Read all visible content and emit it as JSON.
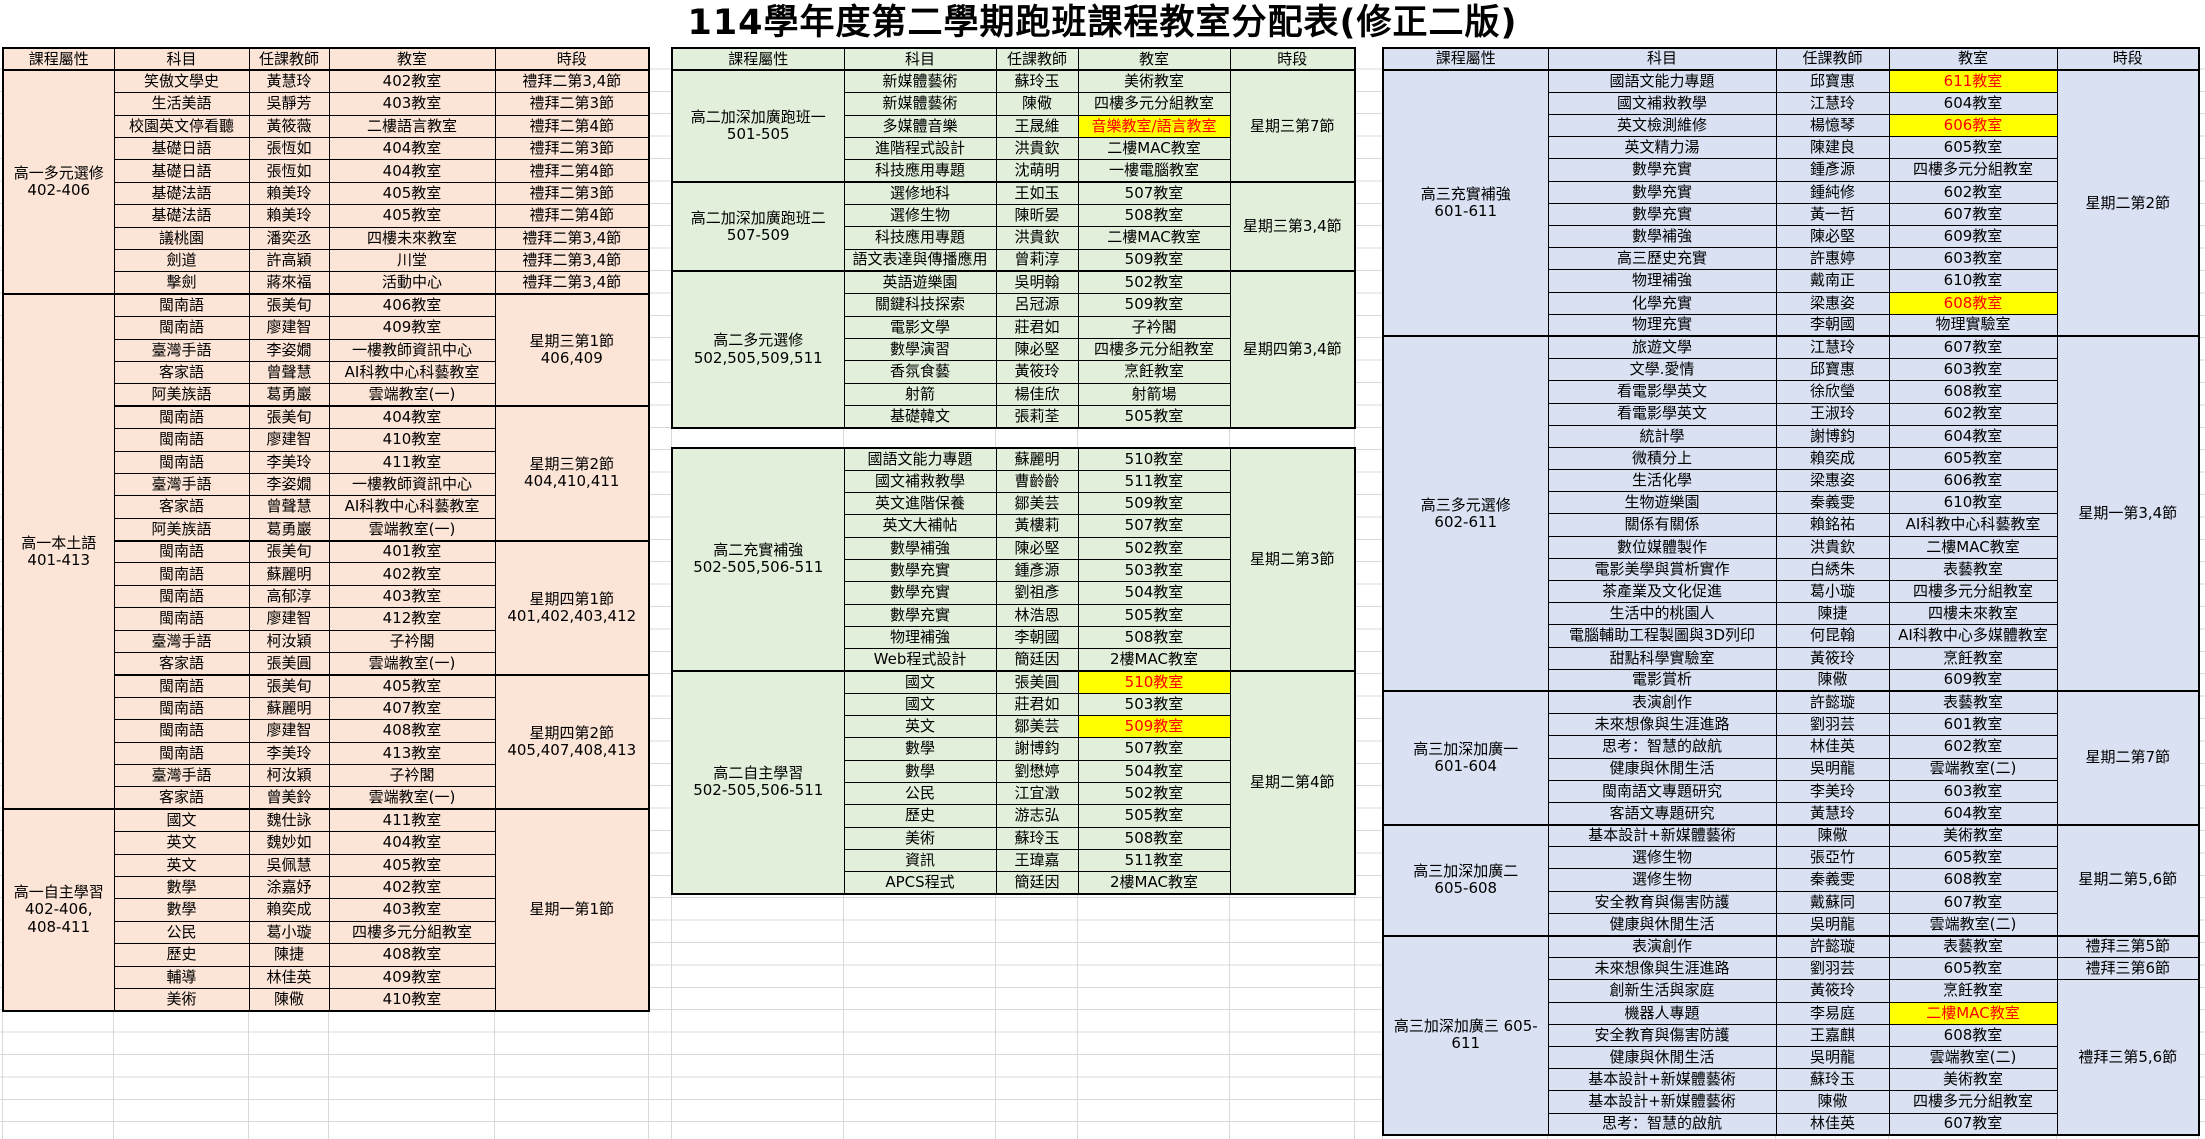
{
  "title": "114學年度第二學期跑班課程教室分配表(修正二版)",
  "colors": {
    "grade1_bg": "#FCE4D6",
    "grade2_bg": "#E2EFDA",
    "grade3_bg": "#D9E1F2",
    "highlight_bg": "#FFFF00",
    "highlight_text": "#FF0000",
    "gridline": "#D9D9D9",
    "border": "#000000"
  },
  "headers": [
    "課程屬性",
    "科目",
    "任課教師",
    "教室",
    "時段"
  ],
  "tables": [
    {
      "name": "grade1",
      "x": 2,
      "y": 47,
      "row_h": 22.4,
      "bg": "#FCE4D6",
      "col_widths": [
        111,
        135,
        80,
        166,
        154
      ],
      "has_header": true,
      "label_spans": [
        {
          "start": 0,
          "count": 10,
          "lines": [
            "高一多元選修",
            "402-406"
          ]
        },
        {
          "start": 10,
          "count": 23,
          "lines": [
            "高一本土語",
            "401-413"
          ]
        },
        {
          "start": 33,
          "count": 9,
          "lines": [
            "高一自主學習",
            "402-406,",
            "408-411"
          ]
        }
      ],
      "time_spans": [
        {
          "start": 0,
          "count": 1,
          "lines": [
            "禮拜二第3,4節"
          ]
        },
        {
          "start": 1,
          "count": 1,
          "lines": [
            "禮拜二第3節"
          ]
        },
        {
          "start": 2,
          "count": 1,
          "lines": [
            "禮拜二第4節"
          ]
        },
        {
          "start": 3,
          "count": 1,
          "lines": [
            "禮拜二第3節"
          ]
        },
        {
          "start": 4,
          "count": 1,
          "lines": [
            "禮拜二第4節"
          ]
        },
        {
          "start": 5,
          "count": 1,
          "lines": [
            "禮拜二第3節"
          ]
        },
        {
          "start": 6,
          "count": 1,
          "lines": [
            "禮拜二第4節"
          ]
        },
        {
          "start": 7,
          "count": 1,
          "lines": [
            "禮拜二第3,4節"
          ]
        },
        {
          "start": 8,
          "count": 1,
          "lines": [
            "禮拜二第3,4節"
          ]
        },
        {
          "start": 9,
          "count": 1,
          "lines": [
            "禮拜二第3,4節"
          ]
        },
        {
          "start": 10,
          "count": 5,
          "lines": [
            "星期三第1節",
            "406,409"
          ]
        },
        {
          "start": 15,
          "count": 6,
          "lines": [
            "星期三第2節",
            "404,410,411"
          ]
        },
        {
          "start": 21,
          "count": 6,
          "lines": [
            "星期四第1節",
            "401,402,403,412"
          ]
        },
        {
          "start": 27,
          "count": 6,
          "lines": [
            "星期四第2節",
            "405,407,408,413"
          ]
        },
        {
          "start": 33,
          "count": 9,
          "lines": [
            "星期一第1節"
          ]
        }
      ],
      "thick_rows": [
        10,
        15,
        21,
        27,
        33
      ],
      "rows": [
        [
          "笑傲文學史",
          "黃慧玲",
          "402教室"
        ],
        [
          "生活美語",
          "吳靜芳",
          "403教室"
        ],
        [
          "校園英文停看聽",
          "黃筱薇",
          "二樓語言教室"
        ],
        [
          "基礎日語",
          "張恆如",
          "404教室"
        ],
        [
          "基礎日語",
          "張恆如",
          "404教室"
        ],
        [
          "基礎法語",
          "賴美玲",
          "405教室"
        ],
        [
          "基礎法語",
          "賴美玲",
          "405教室"
        ],
        [
          "議桃園",
          "潘奕丞",
          "四樓未來教室"
        ],
        [
          "劍道",
          "許高穎",
          "川堂"
        ],
        [
          "擊劍",
          "蔣來福",
          "活動中心"
        ],
        [
          "閩南語",
          "張美旬",
          "406教室"
        ],
        [
          "閩南語",
          "廖建智",
          "409教室"
        ],
        [
          "臺灣手語",
          "李姿嫺",
          "一樓教師資訊中心"
        ],
        [
          "客家語",
          "曾聲慧",
          "AI科教中心科藝教室"
        ],
        [
          "阿美族語",
          "葛勇巖",
          "雲端教室(一)"
        ],
        [
          "閩南語",
          "張美旬",
          "404教室"
        ],
        [
          "閩南語",
          "廖建智",
          "410教室"
        ],
        [
          "閩南語",
          "李美玲",
          "411教室"
        ],
        [
          "臺灣手語",
          "李姿嫺",
          "一樓教師資訊中心"
        ],
        [
          "客家語",
          "曾聲慧",
          "AI科教中心科藝教室"
        ],
        [
          "阿美族語",
          "葛勇巖",
          "雲端教室(一)"
        ],
        [
          "閩南語",
          "張美旬",
          "401教室"
        ],
        [
          "閩南語",
          "蘇麗明",
          "402教室"
        ],
        [
          "閩南語",
          "高郁淳",
          "403教室"
        ],
        [
          "閩南語",
          "廖建智",
          "412教室"
        ],
        [
          "臺灣手語",
          "柯汝穎",
          "子衿閣"
        ],
        [
          "客家語",
          "張美圓",
          "雲端教室(一)"
        ],
        [
          "閩南語",
          "張美旬",
          "405教室"
        ],
        [
          "閩南語",
          "蘇麗明",
          "407教室"
        ],
        [
          "閩南語",
          "廖建智",
          "408教室"
        ],
        [
          "閩南語",
          "李美玲",
          "413教室"
        ],
        [
          "臺灣手語",
          "柯汝穎",
          "子衿閣"
        ],
        [
          "客家語",
          "曾美鈴",
          "雲端教室(一)"
        ],
        [
          "國文",
          "魏仕詠",
          "411教室"
        ],
        [
          "英文",
          "魏妙如",
          "404教室"
        ],
        [
          "英文",
          "吳佩慧",
          "405教室"
        ],
        [
          "數學",
          "涂嘉妤",
          "402教室"
        ],
        [
          "數學",
          "賴奕成",
          "403教室"
        ],
        [
          "公民",
          "葛小璇",
          "四樓多元分組教室"
        ],
        [
          "歷史",
          "陳捷",
          "408教室"
        ],
        [
          "輔導",
          "林佳英",
          "409教室"
        ],
        [
          "美術",
          "陳儆",
          "410教室"
        ]
      ]
    },
    {
      "name": "grade2a",
      "x": 671,
      "y": 47,
      "row_h": 22.35,
      "bg": "#E2EFDA",
      "col_widths": [
        172,
        152,
        82,
        152,
        125
      ],
      "has_header": true,
      "label_spans": [
        {
          "start": 0,
          "count": 5,
          "lines": [
            "高二加深加廣跑班一",
            "501-505"
          ]
        },
        {
          "start": 5,
          "count": 4,
          "lines": [
            "高二加深加廣跑班二",
            "507-509"
          ]
        },
        {
          "start": 9,
          "count": 7,
          "lines": [
            "高二多元選修",
            "502,505,509,511"
          ]
        }
      ],
      "time_spans": [
        {
          "start": 0,
          "count": 5,
          "lines": [
            "星期三第7節"
          ]
        },
        {
          "start": 5,
          "count": 4,
          "lines": [
            "星期三第3,4節"
          ]
        },
        {
          "start": 9,
          "count": 7,
          "lines": [
            "星期四第3,4節"
          ]
        }
      ],
      "thick_rows": [
        5,
        9
      ],
      "rows": [
        [
          "新媒體藝術",
          "蘇玲玉",
          "美術教室"
        ],
        [
          "新媒體藝術",
          "陳儆",
          "四樓多元分組教室"
        ],
        [
          "多媒體音樂",
          "王晟維",
          "音樂教室/語言教室",
          1
        ],
        [
          "進階程式設計",
          "洪貴欽",
          "二樓MAC教室"
        ],
        [
          "科技應用專題",
          "沈萌明",
          "一樓電腦教室"
        ],
        [
          "選修地科",
          "王如玉",
          "507教室"
        ],
        [
          "選修生物",
          "陳昕晏",
          "508教室"
        ],
        [
          "科技應用專題",
          "洪貴欽",
          "二樓MAC教室"
        ],
        [
          "語文表達與傳播應用",
          "曾莉淳",
          "509教室"
        ],
        [
          "英語遊樂園",
          "吳明翰",
          "502教室"
        ],
        [
          "關鍵科技探索",
          "呂冠源",
          "509教室"
        ],
        [
          "電影文學",
          "莊君如",
          "子衿閣"
        ],
        [
          "數學演習",
          "陳必堅",
          "四樓多元分組教室"
        ],
        [
          "香氛食藝",
          "黃筱玲",
          "烹飪教室"
        ],
        [
          "射箭",
          "楊佳欣",
          "射箭場"
        ],
        [
          "基礎韓文",
          "張莉荃",
          "505教室"
        ]
      ]
    },
    {
      "name": "grade2b",
      "x": 671,
      "y": 447,
      "row_h": 22.3,
      "bg": "#E2EFDA",
      "col_widths": [
        172,
        152,
        82,
        152,
        125
      ],
      "has_header": false,
      "label_spans": [
        {
          "start": 0,
          "count": 10,
          "lines": [
            "高二充實補強",
            "502-505,506-511"
          ]
        },
        {
          "start": 10,
          "count": 10,
          "lines": [
            "高二自主學習",
            "502-505,506-511"
          ]
        }
      ],
      "time_spans": [
        {
          "start": 0,
          "count": 10,
          "lines": [
            "星期二第3節"
          ]
        },
        {
          "start": 10,
          "count": 10,
          "lines": [
            "星期二第4節"
          ]
        }
      ],
      "thick_rows": [
        10
      ],
      "rows": [
        [
          "國語文能力專題",
          "蘇麗明",
          "510教室"
        ],
        [
          "國文補救教學",
          "曹齡齡",
          "511教室"
        ],
        [
          "英文進階保養",
          "鄒美芸",
          "509教室"
        ],
        [
          "英文大補帖",
          "黃樓莉",
          "507教室"
        ],
        [
          "數學補強",
          "陳必堅",
          "502教室"
        ],
        [
          "數學充實",
          "鍾彥源",
          "503教室"
        ],
        [
          "數學充實",
          "劉祖彥",
          "504教室"
        ],
        [
          "數學充實",
          "林浩恩",
          "505教室"
        ],
        [
          "物理補強",
          "李朝國",
          "508教室"
        ],
        [
          "Web程式設計",
          "簡廷因",
          "2樓MAC教室"
        ],
        [
          "國文",
          "張美圓",
          "510教室",
          1
        ],
        [
          "國文",
          "莊君如",
          "503教室"
        ],
        [
          "英文",
          "鄒美芸",
          "509教室",
          1
        ],
        [
          "數學",
          "謝博鈞",
          "507教室"
        ],
        [
          "數學",
          "劉懋婷",
          "504教室"
        ],
        [
          "公民",
          "江宜澂",
          "502教室"
        ],
        [
          "歷史",
          "游志弘",
          "505教室"
        ],
        [
          "美術",
          "蘇玲玉",
          "508教室"
        ],
        [
          "資訊",
          "王瑋嘉",
          "511教室"
        ],
        [
          "APCS程式",
          "簡廷因",
          "2樓MAC教室"
        ]
      ]
    },
    {
      "name": "grade3",
      "x": 1382,
      "y": 47,
      "row_h": 22.2,
      "bg": "#D9E1F2",
      "col_widths": [
        165,
        228,
        113,
        168,
        142
      ],
      "has_header": true,
      "label_spans": [
        {
          "start": 0,
          "count": 12,
          "lines": [
            "高三充實補強",
            "601-611"
          ]
        },
        {
          "start": 12,
          "count": 16,
          "lines": [
            "高三多元選修",
            "602-611"
          ]
        },
        {
          "start": 28,
          "count": 6,
          "lines": [
            "高三加深加廣一",
            "601-604"
          ]
        },
        {
          "start": 34,
          "count": 5,
          "lines": [
            "高三加深加廣二",
            "605-608"
          ]
        },
        {
          "start": 39,
          "count": 9,
          "lines": [
            "高三加深加廣三  605-",
            "611"
          ]
        }
      ],
      "time_spans": [
        {
          "start": 0,
          "count": 12,
          "lines": [
            "星期二第2節"
          ]
        },
        {
          "start": 12,
          "count": 16,
          "lines": [
            "星期一第3,4節"
          ]
        },
        {
          "start": 28,
          "count": 6,
          "lines": [
            "星期二第7節"
          ]
        },
        {
          "start": 34,
          "count": 5,
          "lines": [
            "星期二第5,6節"
          ]
        },
        {
          "start": 39,
          "count": 1,
          "lines": [
            "禮拜三第5節"
          ]
        },
        {
          "start": 40,
          "count": 1,
          "lines": [
            "禮拜三第6節"
          ]
        },
        {
          "start": 41,
          "count": 7,
          "lines": [
            "禮拜三第5,6節"
          ]
        }
      ],
      "thick_rows": [
        12,
        28,
        34,
        39
      ],
      "rows": [
        [
          "國語文能力專題",
          "邱寶惠",
          "611教室",
          1
        ],
        [
          "國文補救教學",
          "江慧玲",
          "604教室"
        ],
        [
          "英文檢測維修",
          "楊憶琴",
          "606教室",
          1
        ],
        [
          "英文精力湯",
          "陳建良",
          "605教室"
        ],
        [
          "數學充實",
          "鍾彥源",
          "四樓多元分組教室"
        ],
        [
          "數學充實",
          "鍾純修",
          "602教室"
        ],
        [
          "數學充實",
          "黃一哲",
          "607教室"
        ],
        [
          "數學補強",
          "陳必堅",
          "609教室"
        ],
        [
          "高三歷史充實",
          "許惠婷",
          "603教室"
        ],
        [
          "物理補強",
          "戴南正",
          "610教室"
        ],
        [
          "化學充實",
          "梁惠姿",
          "608教室",
          1
        ],
        [
          "物理充實",
          "李朝國",
          "物理實驗室"
        ],
        [
          "旅遊文學",
          "江慧玲",
          "607教室"
        ],
        [
          "文學.愛情",
          "邱寶惠",
          "603教室"
        ],
        [
          "看電影學英文",
          "徐欣瑩",
          "608教室"
        ],
        [
          "看電影學英文",
          "王淑玲",
          "602教室"
        ],
        [
          "統計學",
          "謝博鈞",
          "604教室"
        ],
        [
          "微積分上",
          "賴奕成",
          "605教室"
        ],
        [
          "生活化學",
          "梁惠姿",
          "606教室"
        ],
        [
          "生物遊樂園",
          "秦義雯",
          "610教室"
        ],
        [
          "關係有關係",
          "賴銘祐",
          "AI科教中心科藝教室"
        ],
        [
          "數位媒體製作",
          "洪貴欽",
          "二樓MAC教室"
        ],
        [
          "電影美學與賞析實作",
          "白綉朱",
          "表藝教室"
        ],
        [
          "茶產業及文化促進",
          "葛小璇",
          "四樓多元分組教室"
        ],
        [
          "生活中的桃園人",
          "陳捷",
          "四樓未來教室"
        ],
        [
          "電腦輔助工程製圖與3D列印",
          "何昆翰",
          "AI科教中心多媒體教室"
        ],
        [
          "甜點科學實驗室",
          "黃筱玲",
          "烹飪教室"
        ],
        [
          "電影賞析",
          "陳儆",
          "609教室"
        ],
        [
          "表演創作",
          "許懿璇",
          "表藝教室"
        ],
        [
          "未來想像與生涯進路",
          "劉羽芸",
          "601教室"
        ],
        [
          "思考：智慧的啟航",
          "林佳英",
          "602教室"
        ],
        [
          "健康與休閒生活",
          "吳明龍",
          "雲端教室(二)"
        ],
        [
          "閩南語文專題研究",
          "李美玲",
          "603教室"
        ],
        [
          "客語文專題研究",
          "黃慧玲",
          "604教室"
        ],
        [
          "基本設計+新媒體藝術",
          "陳儆",
          "美術教室"
        ],
        [
          "選修生物",
          "張亞竹",
          "605教室"
        ],
        [
          "選修生物",
          "秦義雯",
          "608教室"
        ],
        [
          "安全教育與傷害防護",
          "戴蘇同",
          "607教室"
        ],
        [
          "健康與休閒生活",
          "吳明龍",
          "雲端教室(二)"
        ],
        [
          "表演創作",
          "許懿璇",
          "表藝教室"
        ],
        [
          "未來想像與生涯進路",
          "劉羽芸",
          "605教室"
        ],
        [
          "創新生活與家庭",
          "黃筱玲",
          "烹飪教室"
        ],
        [
          "機器人專題",
          "李易庭",
          "二樓MAC教室",
          1
        ],
        [
          "安全教育與傷害防護",
          "王嘉麒",
          "608教室"
        ],
        [
          "健康與休閒生活",
          "吳明龍",
          "雲端教室(二)"
        ],
        [
          "基本設計+新媒體藝術",
          "蘇玲玉",
          "美術教室"
        ],
        [
          "基本設計+新媒體藝術",
          "陳儆",
          "四樓多元分組教室"
        ],
        [
          "思考：智慧的啟航",
          "林佳英",
          "607教室"
        ]
      ]
    }
  ]
}
